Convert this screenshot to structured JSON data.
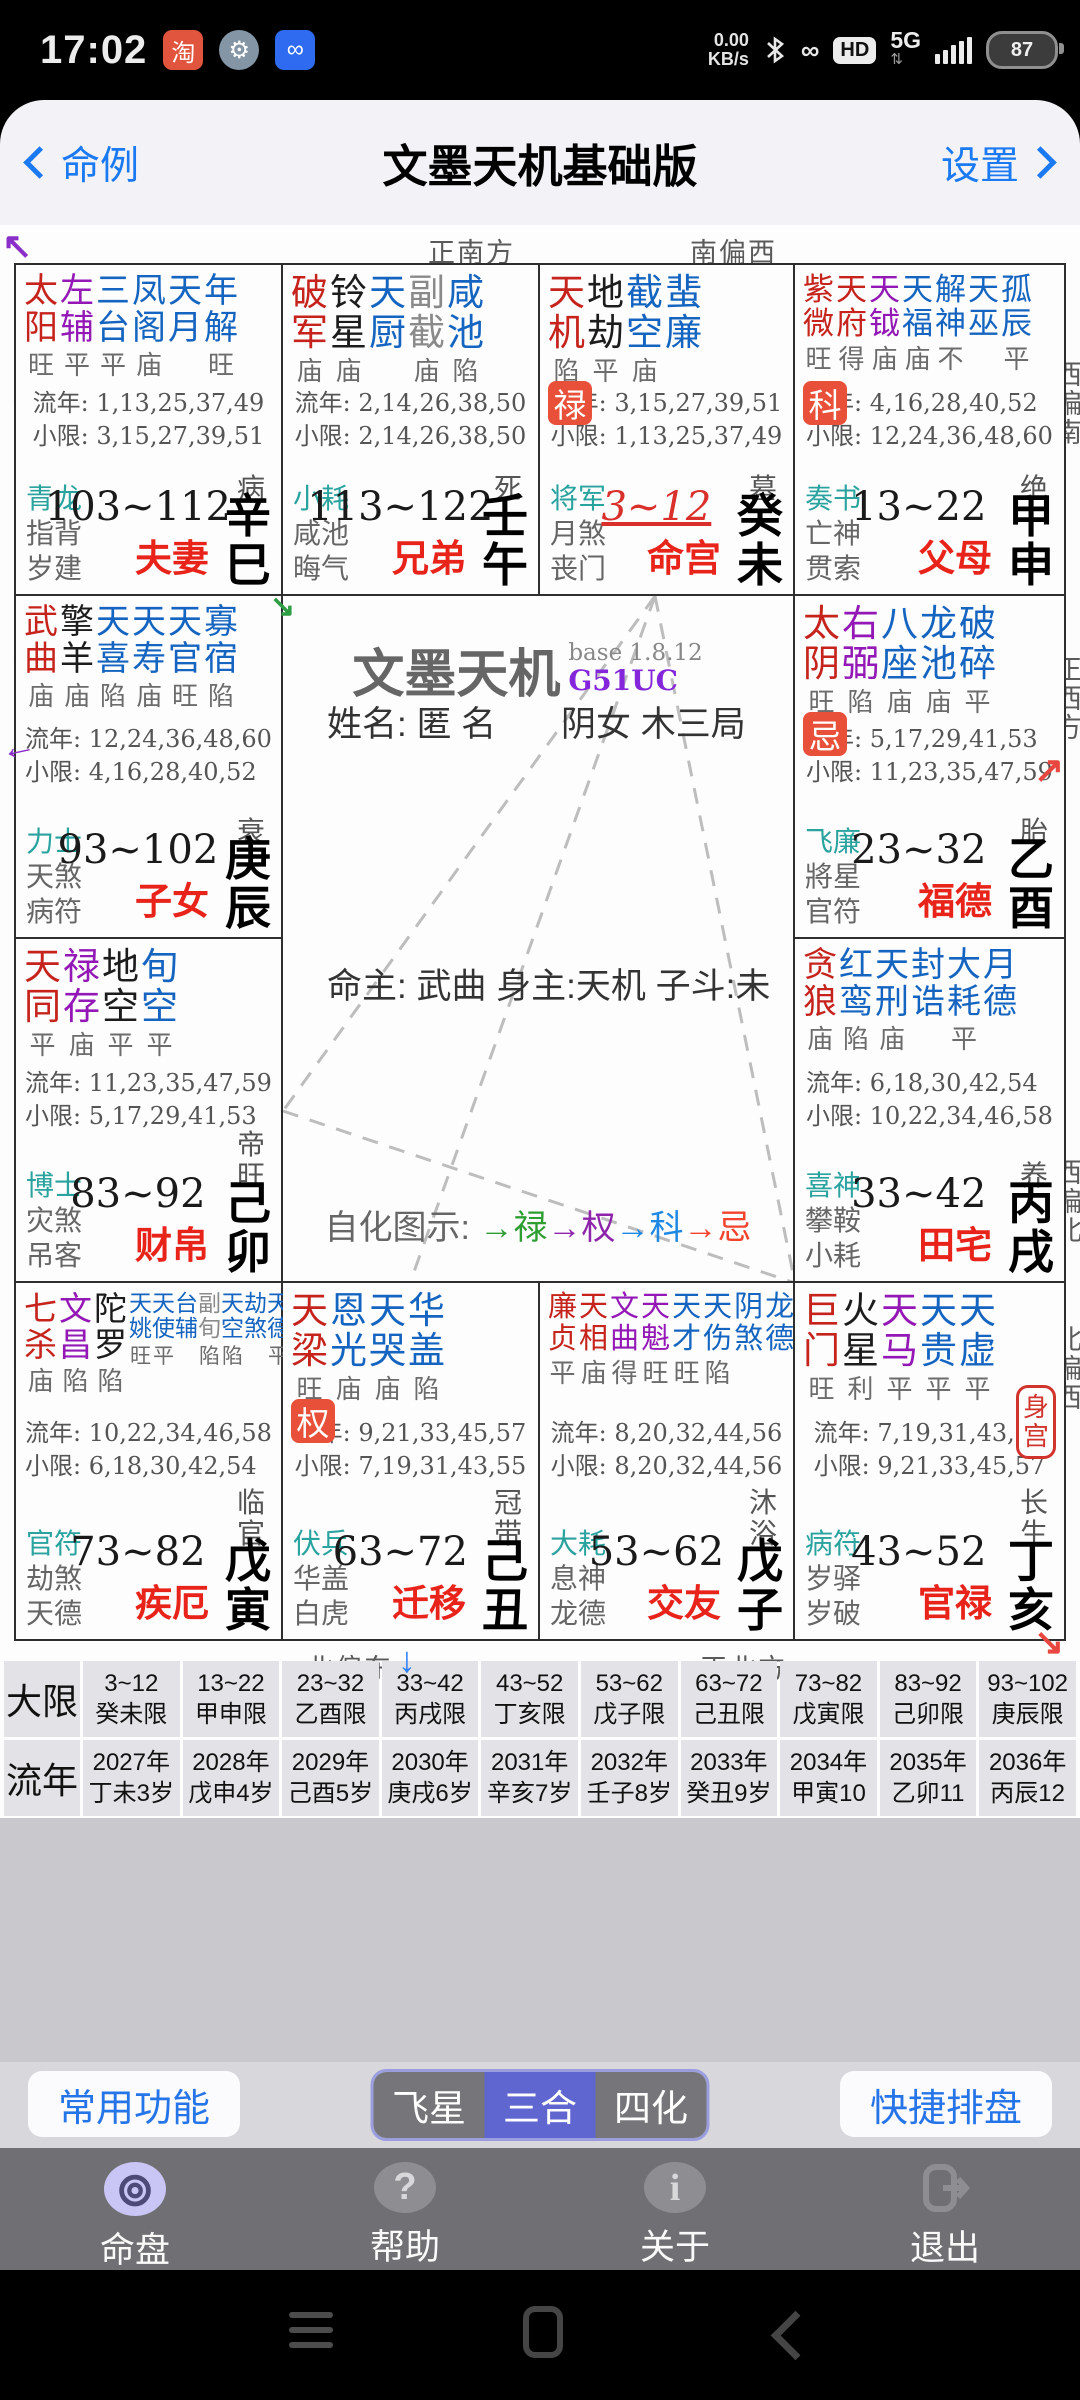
{
  "status_bar": {
    "time": "17:02",
    "taobao_glyph": "淘",
    "speed_value": "0.00",
    "speed_unit": "KB/s",
    "hd_label": "HD",
    "network": "5G",
    "battery": "87"
  },
  "title_bar": {
    "back": "命例",
    "title": "文墨天机基础版",
    "settings": "设置"
  },
  "compass": {
    "top": [
      "正南方",
      "南偏西"
    ],
    "bottom": [
      "北偏东",
      "正北方"
    ],
    "left": [
      "南偏东",
      "东偏南",
      "正东方",
      "东偏北"
    ],
    "right": [
      "西偏南",
      "正西方",
      "西偏北",
      "北偏西"
    ]
  },
  "center": {
    "app_title": "文墨天机",
    "version": "base 1.8.12",
    "build": "G51UC",
    "name_line": "姓名: 匿 名",
    "sex_line": "阴女 木三局",
    "masters_line": "命主: 武曲 身主:天机 子斗:未",
    "sihua_parts": [
      {
        "text": "自化图示: ",
        "color": "#666666"
      },
      {
        "text": "→禄",
        "color": "#2f9e32"
      },
      {
        "text": "→权",
        "color": "#8e24aa"
      },
      {
        "text": "→科",
        "color": "#1e88e5"
      },
      {
        "text": "→忌",
        "color": "#f4432c"
      }
    ]
  },
  "colors": {
    "star_map": {
      "r": "#c5231c",
      "p": "#9318b5",
      "b": "#1565c0",
      "k": "#1c1c1c",
      "g": "#8a8a8a"
    },
    "god_first": "#2aa39f",
    "palace_name": "#e8231a",
    "badge_bg": "#e8503a",
    "current_age": "#d9302c"
  },
  "body_palace_label": "身宫",
  "palaces": [
    {
      "grid": [
        1,
        1
      ],
      "stars": [
        {
          "t": "太阳",
          "c": "r",
          "b": "旺"
        },
        {
          "t": "左辅",
          "c": "p",
          "b": "平"
        },
        {
          "t": "三台",
          "c": "b",
          "b": "平"
        },
        {
          "t": "凤阁",
          "c": "b",
          "b": "庙"
        },
        {
          "t": "天月",
          "c": "b",
          "b": ""
        },
        {
          "t": "年解",
          "c": "b",
          "b": "旺"
        }
      ],
      "badge": "",
      "ln": "流年: 1,13,25,37,49",
      "xx": "小限: 3,15,27,39,51",
      "gods": [
        "青龙",
        "指背",
        "岁建"
      ],
      "age": "103~112",
      "current": false,
      "stage": "病",
      "stem": "辛巳",
      "name": "夫妻",
      "body": false
    },
    {
      "grid": [
        1,
        2
      ],
      "stars": [
        {
          "t": "破军",
          "c": "r",
          "b": "庙"
        },
        {
          "t": "铃星",
          "c": "k",
          "b": "庙"
        },
        {
          "t": "天厨",
          "c": "b",
          "b": ""
        },
        {
          "t": "副截",
          "c": "g",
          "b": "庙"
        },
        {
          "t": "咸池",
          "c": "b",
          "b": "陷"
        }
      ],
      "badge": "",
      "ln": "流年: 2,14,26,38,50",
      "xx": "小限: 2,14,26,38,50",
      "gods": [
        "小耗",
        "咸池",
        "晦气"
      ],
      "age": "113~122",
      "current": false,
      "stage": "死",
      "stem": "壬午",
      "name": "兄弟",
      "body": false
    },
    {
      "grid": [
        1,
        3
      ],
      "stars": [
        {
          "t": "天机",
          "c": "r",
          "b": "陷"
        },
        {
          "t": "地劫",
          "c": "k",
          "b": "平"
        },
        {
          "t": "截空",
          "c": "b",
          "b": "庙"
        },
        {
          "t": "蜚廉",
          "c": "b",
          "b": ""
        }
      ],
      "badge": "禄",
      "ln": "流年: 3,15,27,39,51",
      "xx": "小限: 1,13,25,37,49",
      "gods": [
        "将军",
        "月煞",
        "丧门"
      ],
      "age": "3~12",
      "current": true,
      "stage": "墓",
      "stem": "癸未",
      "name": "命宫",
      "body": false
    },
    {
      "grid": [
        1,
        4
      ],
      "stars": [
        {
          "t": "紫微",
          "c": "r",
          "b": "旺"
        },
        {
          "t": "天府",
          "c": "r",
          "b": "得"
        },
        {
          "t": "天钺",
          "c": "p",
          "b": "庙"
        },
        {
          "t": "天福",
          "c": "b",
          "b": "庙"
        },
        {
          "t": "解神",
          "c": "b",
          "b": "不"
        },
        {
          "t": "天巫",
          "c": "b",
          "b": ""
        },
        {
          "t": "孤辰",
          "c": "b",
          "b": "平"
        }
      ],
      "badge": "科",
      "ln": "流年: 4,16,28,40,52",
      "xx": "小限: 12,24,36,48,60",
      "gods": [
        "奏书",
        "亡神",
        "贯索"
      ],
      "age": "13~22",
      "current": false,
      "stage": "绝",
      "stem": "甲申",
      "name": "父母",
      "body": false
    },
    {
      "grid": [
        2,
        1
      ],
      "stars": [
        {
          "t": "武曲",
          "c": "r",
          "b": "庙"
        },
        {
          "t": "擎羊",
          "c": "k",
          "b": "庙"
        },
        {
          "t": "天喜",
          "c": "b",
          "b": "陷"
        },
        {
          "t": "天寿",
          "c": "b",
          "b": "庙"
        },
        {
          "t": "天官",
          "c": "b",
          "b": "旺"
        },
        {
          "t": "寡宿",
          "c": "b",
          "b": "陷"
        }
      ],
      "badge": "",
      "ln": "流年: 12,24,36,48,60",
      "xx": "小限: 4,16,28,40,52",
      "gods": [
        "力士",
        "天煞",
        "病符"
      ],
      "age": "93~102",
      "current": false,
      "stage": "衰",
      "stem": "庚辰",
      "name": "子女",
      "body": false
    },
    {
      "grid": [
        2,
        4
      ],
      "stars": [
        {
          "t": "太阴",
          "c": "r",
          "b": "旺"
        },
        {
          "t": "右弼",
          "c": "p",
          "b": "陷"
        },
        {
          "t": "八座",
          "c": "b",
          "b": "庙"
        },
        {
          "t": "龙池",
          "c": "b",
          "b": "庙"
        },
        {
          "t": "破碎",
          "c": "b",
          "b": "平"
        }
      ],
      "badge": "忌",
      "ln": "流年: 5,17,29,41,53",
      "xx": "小限: 11,23,35,47,59",
      "gods": [
        "飞廉",
        "將星",
        "官符"
      ],
      "age": "23~32",
      "current": false,
      "stage": "胎",
      "stem": "乙酉",
      "name": "福德",
      "body": false
    },
    {
      "grid": [
        3,
        1
      ],
      "stars": [
        {
          "t": "天同",
          "c": "r",
          "b": "平"
        },
        {
          "t": "禄存",
          "c": "p",
          "b": "庙"
        },
        {
          "t": "地空",
          "c": "k",
          "b": "平"
        },
        {
          "t": "旬空",
          "c": "b",
          "b": "平"
        }
      ],
      "badge": "",
      "ln": "流年: 11,23,35,47,59",
      "xx": "小限: 5,17,29,41,53",
      "gods": [
        "博士",
        "灾煞",
        "吊客"
      ],
      "age": "83~92",
      "current": false,
      "stage": "帝旺",
      "stem": "己卯",
      "name": "财帛",
      "body": false
    },
    {
      "grid": [
        3,
        4
      ],
      "stars": [
        {
          "t": "贪狼",
          "c": "r",
          "b": "庙"
        },
        {
          "t": "红鸾",
          "c": "b",
          "b": "陷"
        },
        {
          "t": "天刑",
          "c": "b",
          "b": "庙"
        },
        {
          "t": "封诰",
          "c": "b",
          "b": ""
        },
        {
          "t": "大耗",
          "c": "b",
          "b": "平"
        },
        {
          "t": "月德",
          "c": "b",
          "b": ""
        }
      ],
      "badge": "",
      "ln": "流年: 6,18,30,42,54",
      "xx": "小限: 10,22,34,46,58",
      "gods": [
        "喜神",
        "攀鞍",
        "小耗"
      ],
      "age": "33~42",
      "current": false,
      "stage": "养",
      "stem": "丙戌",
      "name": "田宅",
      "body": false
    },
    {
      "grid": [
        4,
        1
      ],
      "stars": [
        {
          "t": "七杀",
          "c": "r",
          "b": "庙"
        },
        {
          "t": "文昌",
          "c": "p",
          "b": "陷"
        },
        {
          "t": "陀罗",
          "c": "k",
          "b": "陷"
        },
        {
          "t": "天姚",
          "c": "b",
          "b": "旺",
          "s": 1
        },
        {
          "t": "天使",
          "c": "b",
          "b": "平",
          "s": 1
        },
        {
          "t": "台辅",
          "c": "b",
          "b": "",
          "s": 1
        },
        {
          "t": "副旬",
          "c": "g",
          "b": "陷",
          "s": 1
        },
        {
          "t": "天空",
          "c": "b",
          "b": "陷",
          "s": 1
        },
        {
          "t": "劫煞",
          "c": "b",
          "b": "",
          "s": 1
        },
        {
          "t": "天德",
          "c": "b",
          "b": "平",
          "s": 1
        }
      ],
      "badge": "",
      "ln": "流年: 10,22,34,46,58",
      "xx": "小限: 6,18,30,42,54",
      "gods": [
        "官符",
        "劫煞",
        "天德"
      ],
      "age": "73~82",
      "current": false,
      "stage": "临官",
      "stem": "戊寅",
      "name": "疾厄",
      "body": false
    },
    {
      "grid": [
        4,
        2
      ],
      "stars": [
        {
          "t": "天梁",
          "c": "r",
          "b": "旺"
        },
        {
          "t": "恩光",
          "c": "b",
          "b": "庙"
        },
        {
          "t": "天哭",
          "c": "b",
          "b": "庙"
        },
        {
          "t": "华盖",
          "c": "b",
          "b": "陷"
        }
      ],
      "badge": "权",
      "ln": "流年: 9,21,33,45,57",
      "xx": "小限: 7,19,31,43,55",
      "gods": [
        "伏兵",
        "华盖",
        "白虎"
      ],
      "age": "63~72",
      "current": false,
      "stage": "冠带",
      "stem": "己丑",
      "name": "迁移",
      "body": false
    },
    {
      "grid": [
        4,
        3
      ],
      "stars": [
        {
          "t": "廉贞",
          "c": "r",
          "b": "平"
        },
        {
          "t": "天相",
          "c": "r",
          "b": "庙"
        },
        {
          "t": "文曲",
          "c": "p",
          "b": "得"
        },
        {
          "t": "天魁",
          "c": "p",
          "b": "旺"
        },
        {
          "t": "天才",
          "c": "b",
          "b": "旺"
        },
        {
          "t": "天伤",
          "c": "b",
          "b": "陷"
        },
        {
          "t": "阴煞",
          "c": "b",
          "b": ""
        },
        {
          "t": "龙德",
          "c": "b",
          "b": ""
        }
      ],
      "badge": "",
      "ln": "流年: 8,20,32,44,56",
      "xx": "小限: 8,20,32,44,56",
      "gods": [
        "大耗",
        "息神",
        "龙德"
      ],
      "age": "53~62",
      "current": false,
      "stage": "沐浴",
      "stem": "戊子",
      "name": "交友",
      "body": false
    },
    {
      "grid": [
        4,
        4
      ],
      "stars": [
        {
          "t": "巨门",
          "c": "r",
          "b": "旺"
        },
        {
          "t": "火星",
          "c": "k",
          "b": "利"
        },
        {
          "t": "天马",
          "c": "p",
          "b": "平"
        },
        {
          "t": "天贵",
          "c": "b",
          "b": "平"
        },
        {
          "t": "天虚",
          "c": "b",
          "b": "平"
        }
      ],
      "badge": "",
      "ln": "流年: 7,19,31,43,55",
      "xx": "小限: 9,21,33,45,57",
      "gods": [
        "病符",
        "岁驿",
        "岁破"
      ],
      "age": "43~52",
      "current": false,
      "stage": "长生",
      "stem": "丁亥",
      "name": "官禄",
      "body": true
    }
  ],
  "tables": {
    "daxian_label": "大限",
    "daxian": [
      {
        "l1": "3~12",
        "l2": "癸未限"
      },
      {
        "l1": "13~22",
        "l2": "甲申限"
      },
      {
        "l1": "23~32",
        "l2": "乙酉限"
      },
      {
        "l1": "33~42",
        "l2": "丙戌限"
      },
      {
        "l1": "43~52",
        "l2": "丁亥限"
      },
      {
        "l1": "53~62",
        "l2": "戊子限"
      },
      {
        "l1": "63~72",
        "l2": "己丑限"
      },
      {
        "l1": "73~82",
        "l2": "戊寅限"
      },
      {
        "l1": "83~92",
        "l2": "己卯限"
      },
      {
        "l1": "93~102",
        "l2": "庚辰限"
      }
    ],
    "liunian_label": "流年",
    "liunian": [
      {
        "l1": "2027年",
        "l2": "丁未3岁"
      },
      {
        "l1": "2028年",
        "l2": "戊申4岁"
      },
      {
        "l1": "2029年",
        "l2": "己酉5岁"
      },
      {
        "l1": "2030年",
        "l2": "庚戌6岁"
      },
      {
        "l1": "2031年",
        "l2": "辛亥7岁"
      },
      {
        "l1": "2032年",
        "l2": "壬子8岁"
      },
      {
        "l1": "2033年",
        "l2": "癸丑9岁"
      },
      {
        "l1": "2034年",
        "l2": "甲寅10"
      },
      {
        "l1": "2035年",
        "l2": "乙卯11"
      },
      {
        "l1": "2036年",
        "l2": "丙辰12"
      }
    ]
  },
  "action_bar": {
    "left_button": "常用功能",
    "segments": [
      "飞星",
      "三合",
      "四化"
    ],
    "selected_segment": "三合",
    "right_button": "快捷排盘"
  },
  "bottom_nav": [
    {
      "label": "命盘",
      "icon": "chart-wheel-icon",
      "active": true
    },
    {
      "label": "帮助",
      "icon": "help-icon",
      "active": false
    },
    {
      "label": "关于",
      "icon": "info-icon",
      "active": false
    },
    {
      "label": "退出",
      "icon": "exit-icon",
      "active": false
    }
  ]
}
